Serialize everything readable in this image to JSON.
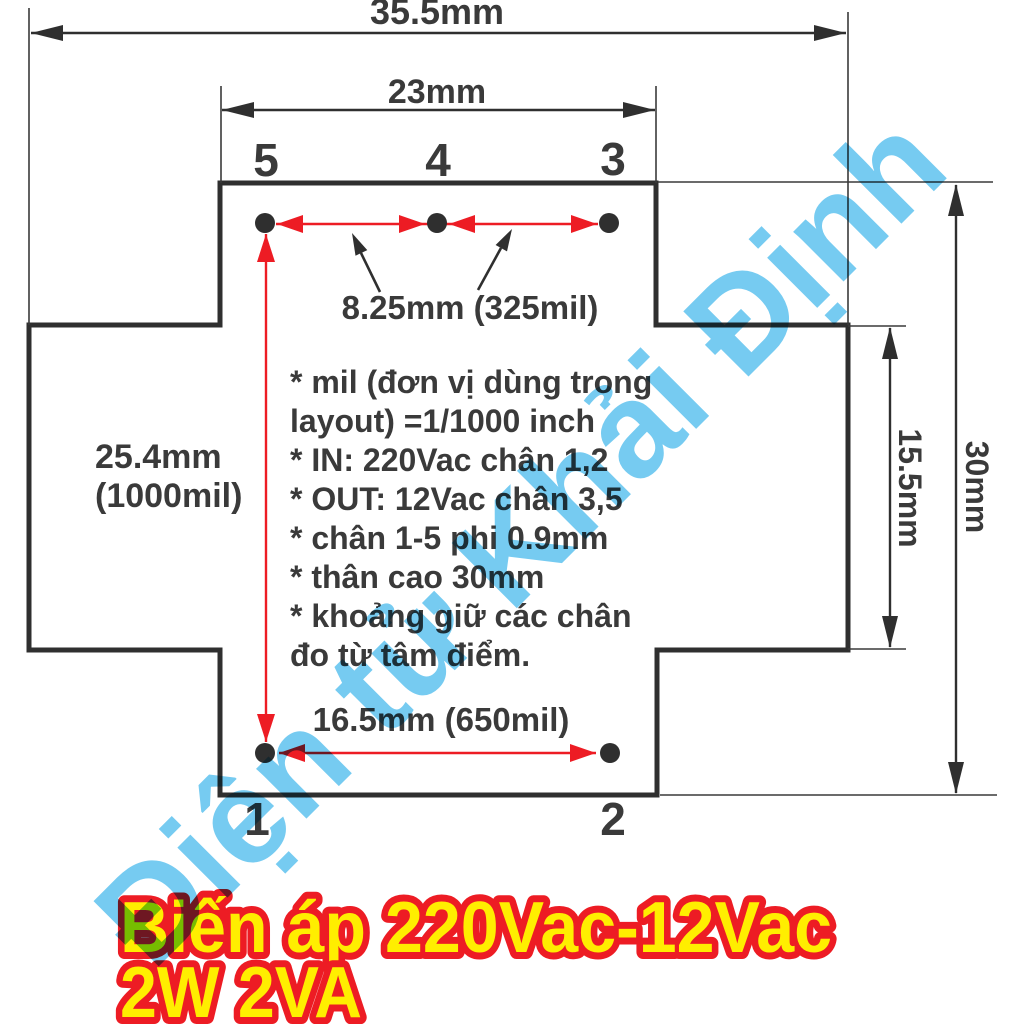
{
  "watermark": {
    "text": "Điện tử Khải Định",
    "color": "#76cbf1"
  },
  "dimensions": {
    "overall_width": "35.5mm",
    "top_width": "23mm",
    "pin_pitch_top": "8.25mm (325mil)",
    "row_spacing": [
      "25.4mm",
      "(1000mil)"
    ],
    "pin_pitch_bottom": "16.5mm (650mil)",
    "side_height": "15.5mm",
    "overall_height": "30mm"
  },
  "pins": {
    "top": [
      "5",
      "4",
      "3"
    ],
    "bottom": [
      "1",
      "2"
    ]
  },
  "notes": {
    "lines": [
      "* mil (đơn vị dùng trong",
      "layout)  =1/1000 inch",
      "* IN: 220Vac chân 1,2",
      "* OUT: 12Vac chân 3,5",
      "* chân 1-5 phi 0.9mm",
      "* thân cao 30mm",
      "* khoảng giữ các chân",
      "đo từ tâm điểm."
    ]
  },
  "title": {
    "line1": "Biến áp 220Vac-12Vac",
    "line2": "2W 2VA"
  },
  "colors": {
    "outline": "#2f2f2f",
    "text": "#3a3a3a",
    "red_accent": "#ed1c24",
    "watermark_blue": "#76cbf1",
    "title_fill": "#ffee00",
    "title_outline": "#ed1c24"
  }
}
